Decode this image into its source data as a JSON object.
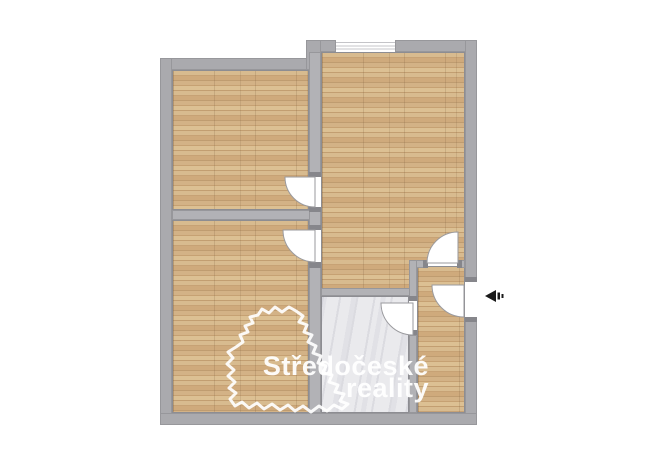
{
  "watermark": {
    "brand_line1": "Středočeské",
    "brand_line2": "reality"
  },
  "icons": {
    "entrance_arrow": "left-pointing entrance arrow",
    "region_outline": "central-bohemia-region-outline"
  },
  "colors": {
    "wall_gray": "#aaaaae",
    "interior_wall_gray": "#b2b2b6",
    "wood_floor": "#cfab7d",
    "bathroom_tile": "#eaeaed",
    "door_swing_white": "#ffffff",
    "watermark_white": "#ffffff",
    "entrance_arrow_black": "#1a1a1a",
    "background": "#ffffff"
  }
}
